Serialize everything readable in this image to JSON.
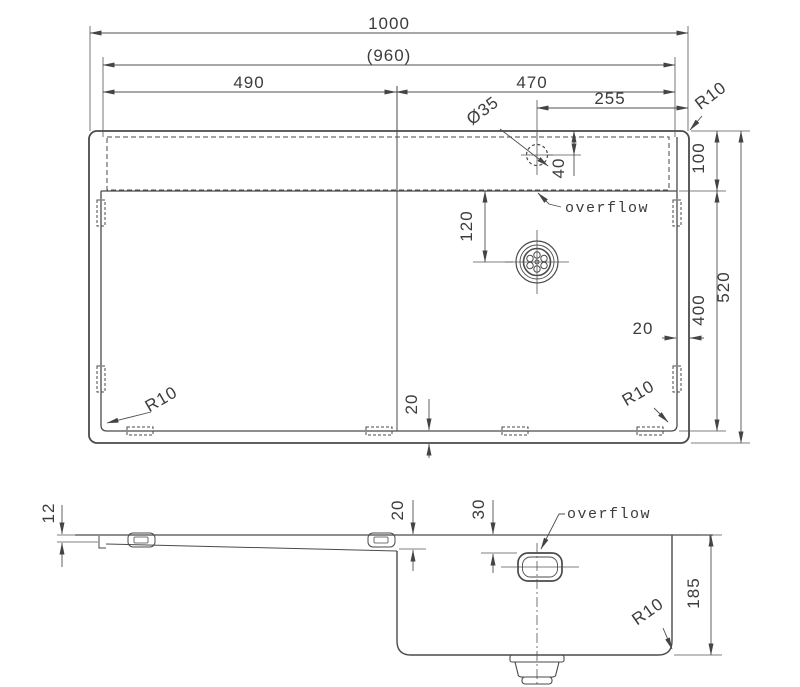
{
  "drawing": {
    "type": "technical-dimension-drawing",
    "subject": "kitchen sink with drainboard, plan view and section view",
    "units": "mm",
    "line_color": "#4a4a4a",
    "background": "#ffffff",
    "top_view": {
      "overall_width": "1000",
      "inner_width": "(960)",
      "drainboard_width": "490",
      "bowl_width": "470",
      "faucet_to_edge": "255",
      "faucet_hole_diameter": "Ø35",
      "faucet_from_top_edge": "40",
      "ledge_depth": "100",
      "overall_depth": "520",
      "bowl_length": "400",
      "drain_from_ledge": "120",
      "right_rim": "20",
      "bottom_rim": "20",
      "radius_top_right": "R10",
      "radius_bottom_left": "R10",
      "radius_bottom_right": "R10",
      "overflow_label": "overflow"
    },
    "section_view": {
      "front_edge_height": "12",
      "drainboard_drop": "20",
      "overflow_from_top": "30",
      "bowl_depth": "185",
      "radius_bottom": "R10",
      "overflow_label": "overflow"
    }
  }
}
